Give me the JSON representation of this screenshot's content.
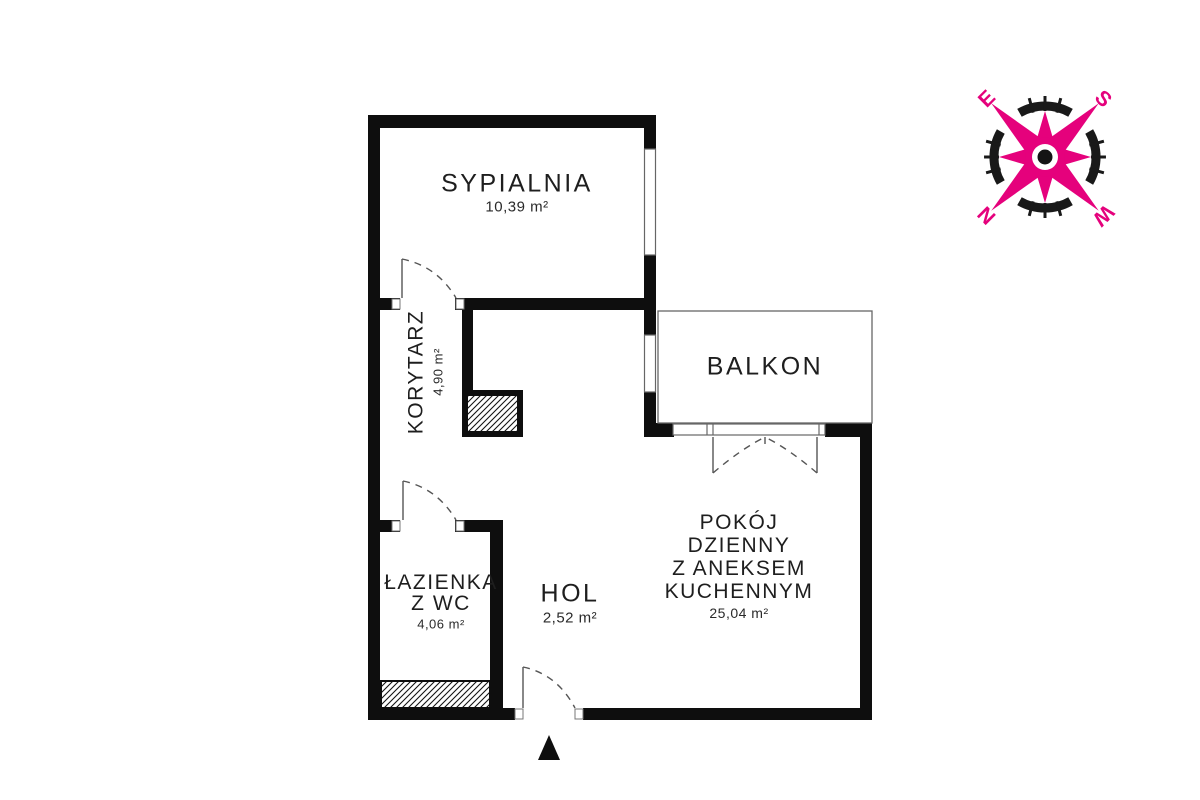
{
  "rooms": {
    "sypialnia": {
      "name": "SYPIALNIA",
      "area": "10,39 m²"
    },
    "korytarz": {
      "name": "KORYTARZ",
      "area": "4,90 m²"
    },
    "balkon": {
      "name": "BALKON"
    },
    "lazienka": {
      "line1": "ŁAZIENKA",
      "line2": "Z WC",
      "area": "4,06 m²"
    },
    "hol": {
      "name": "HOL",
      "area": "2,52 m²"
    },
    "pokoj": {
      "line1": "POKÓJ",
      "line2": "DZIENNY",
      "line3": "Z ANEKSEM",
      "line4": "KUCHENNYM",
      "area": "25,04 m²"
    }
  },
  "compass": {
    "n": "N",
    "e": "E",
    "s": "S",
    "w": "W"
  },
  "colors": {
    "wall": "#0e0e0e",
    "thin_line": "#666666",
    "door_line": "#555555",
    "accent_pink": "#e5017c",
    "compass_ring": "#191919",
    "text": "#1e1e1e"
  }
}
